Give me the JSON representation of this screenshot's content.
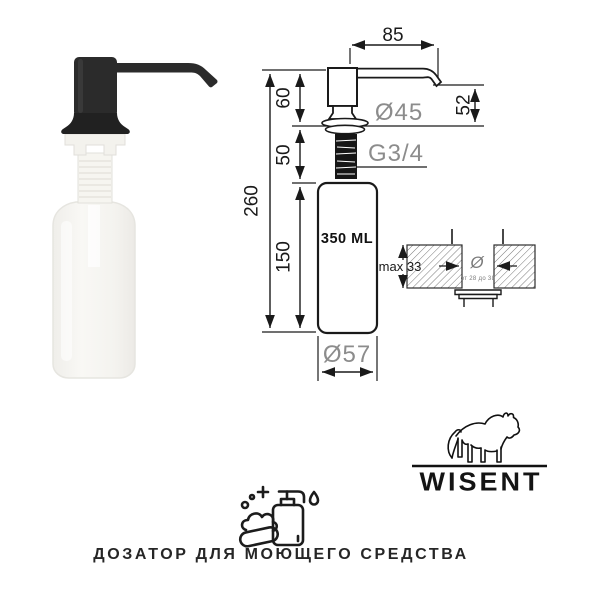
{
  "drawing": {
    "spout_reach": "85",
    "pump_height": "60",
    "thread_length": "50",
    "total_height": "260",
    "bottle_height": "150",
    "spout_drop": "52",
    "flange_diameter": "Ø45",
    "thread_size": "G3/4",
    "volume": "350 ML",
    "bottle_diameter": "Ø57"
  },
  "mounting": {
    "max_thickness": "max 33",
    "hole_symbol": "Ø",
    "hole_range": "от 28 до 38"
  },
  "brand": {
    "name": "WISENT"
  },
  "caption": {
    "text": "ДОЗАТОР ДЛЯ МОЮЩЕГО СРЕДСТВА"
  },
  "icons": {
    "bison_logo": "bison-line-art",
    "soap_icon": "soap-bar-and-dispenser-line-art"
  },
  "colors": {
    "line": "#1a1a1a",
    "gray_label": "#8c8c8c",
    "pump_black": "#2b2b2b",
    "background": "#ffffff"
  }
}
